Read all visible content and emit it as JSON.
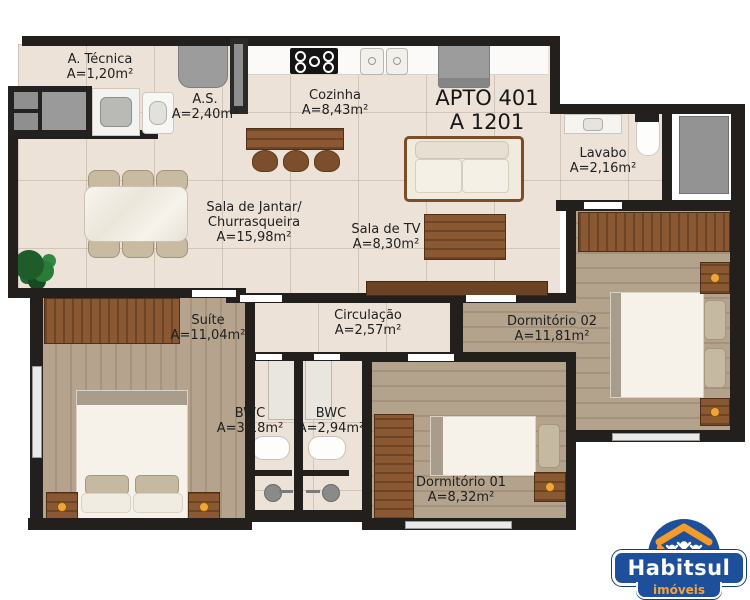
{
  "plan": {
    "title": "APTO 401",
    "unit": "A 1201",
    "rooms": {
      "tecnica": {
        "name": "A. Técnica",
        "area": "A=1,20m²"
      },
      "as": {
        "name": "A.S.",
        "area": "A=2,40m²"
      },
      "cozinha": {
        "name": "Cozinha",
        "area": "A=8,43m²"
      },
      "lavabo": {
        "name": "Lavabo",
        "area": "A=2,16m²"
      },
      "jantar": {
        "name": "Sala de Jantar/",
        "name2": "Churrasqueira",
        "area": "A=15,98m²"
      },
      "tv": {
        "name": "Sala de TV",
        "area": "A=8,30m²"
      },
      "circulacao": {
        "name": "Circulação",
        "area": "A=2,57m²"
      },
      "suite": {
        "name": "Suíte",
        "area": "A=11,04m²"
      },
      "bwc1": {
        "name": "BWC",
        "area": "A=3,18m²"
      },
      "bwc2": {
        "name": "BWC",
        "area": "A=2,94m²"
      },
      "dorm2": {
        "name": "Dormitório 02",
        "area": "A=11,81m²"
      },
      "dorm1": {
        "name": "Dormitório 01",
        "area": "A=8,32m²"
      }
    },
    "furniture": {
      "cozinha": [
        "counter",
        "cooktop",
        "double-sink",
        "refrigerator"
      ],
      "as": [
        "utility-cabinet",
        "laundry-tub",
        "sink",
        "water-heater",
        "entry-door"
      ],
      "jantar": [
        "marble-dining-table",
        "six-chairs",
        "bar-counter",
        "three-stools",
        "plant"
      ],
      "tv": [
        "sofa",
        "tv-stand",
        "sideboard"
      ],
      "lavabo": [
        "sink-counter",
        "toilet"
      ],
      "suite": [
        "wardrobe",
        "double-bed",
        "two-nightstands",
        "window"
      ],
      "bwc1": [
        "vanity",
        "toilet",
        "shower"
      ],
      "bwc2": [
        "vanity",
        "toilet",
        "shower"
      ],
      "dorm1": [
        "wardrobe",
        "single-bed",
        "nightstand",
        "window"
      ],
      "dorm2": [
        "wardrobe",
        "double-bed",
        "two-nightstands",
        "window"
      ]
    },
    "colors": {
      "wall": "#221f1c",
      "tile_floor": "#ece2d8",
      "wood_floor": "#b3a28c",
      "furniture_wood": "#8a5833"
    }
  },
  "logo": {
    "brand": "Habitsul",
    "tagline": "imóveis",
    "icon": "house-family-icon",
    "blue": "#1d4f9a",
    "orange": "#f2a33c"
  }
}
